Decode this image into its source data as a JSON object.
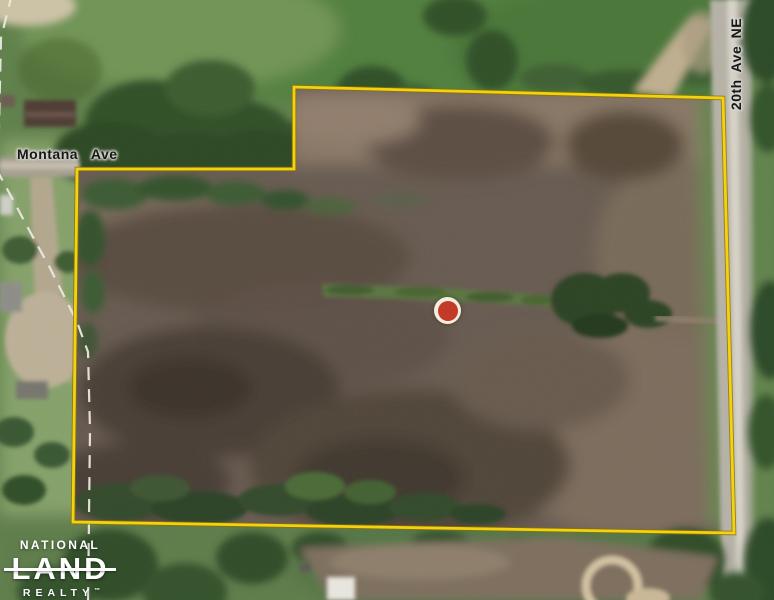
{
  "map": {
    "labels": {
      "montana_ave": "Montana Ave",
      "twentieth_ave_ne": "20th Ave NE"
    },
    "colors": {
      "boundary_yellow": "#F5D409",
      "marker_red": "#C23A28",
      "marker_ring_cream": "#F6EEDD",
      "section_dashed_line": "#ECEAE2",
      "logo_white": "#FFFFFF"
    }
  },
  "logo": {
    "line1": "NATIONAL",
    "line2": "LAND",
    "line3": "REALTY",
    "trademark": "™"
  }
}
